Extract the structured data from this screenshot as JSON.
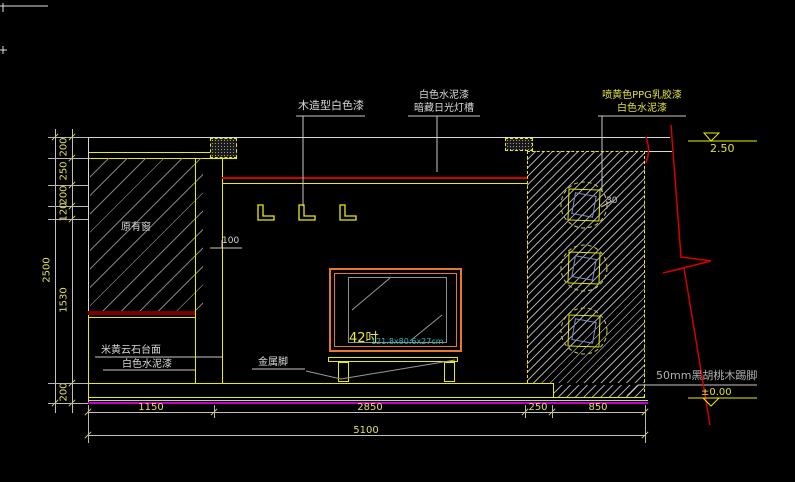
{
  "drawing": {
    "kind": "interior-elevation-cad",
    "colors": {
      "background": "#000000",
      "line_white": "#D8D8D8",
      "line_yellow": "#ECEC00",
      "line_red": "#D40000",
      "line_magenta": "#C800C8",
      "tv_orange": "#E87830",
      "text_cyan": "#30B8B8",
      "sill_darkred": "#7A0000",
      "dim_text": "#E0E060"
    }
  },
  "annotations": {
    "wood_panel": "木造型白色漆",
    "cement_line1": "白色水泥漆",
    "cement_line2": "暗藏日光灯槽",
    "ppg_line1": "喷黄色PPG乳胶漆",
    "ppg_line2": "白色水泥漆",
    "original_window": "原有窗",
    "wall_offset": "100",
    "niche_depth": "30",
    "marble_counter": "米黄云石台面",
    "counter_paint": "白色水泥漆",
    "metal_feet": "金属脚",
    "tv_size": "42吋",
    "tv_spec": "121.8x80.6x27cm",
    "skirting": "50mm黑胡桃木踢脚"
  },
  "levels": {
    "ceiling": "2.50",
    "floor": "±0.00"
  },
  "dimensions": {
    "left_chain": [
      "200",
      "250",
      "200",
      "120",
      "1530",
      "200"
    ],
    "left_total": "2500",
    "bottom_chain": [
      "1150",
      "2850",
      "250",
      "850"
    ],
    "bottom_total": "5100"
  }
}
